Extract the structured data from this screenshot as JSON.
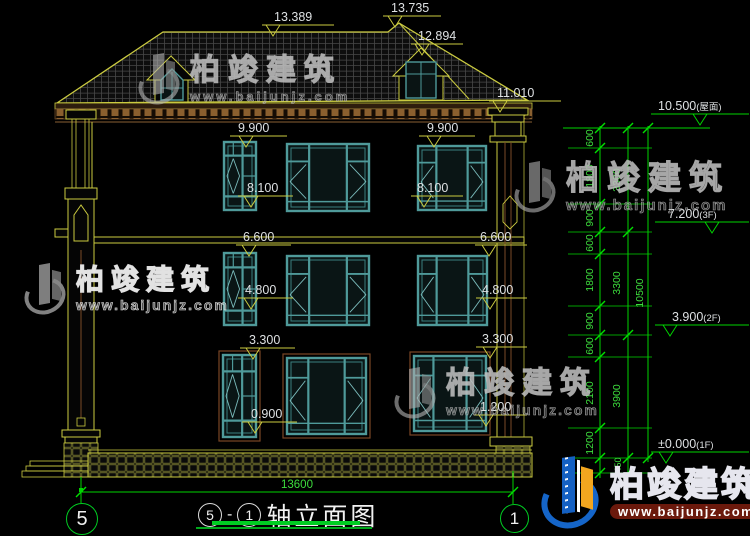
{
  "drawing": {
    "title": {
      "axis_start": "5",
      "dash": "-",
      "axis_end": "1",
      "name": "轴立面图"
    },
    "axis_bubbles": {
      "left": "5",
      "right": "1"
    },
    "bottom_dim": "13600"
  },
  "brand": {
    "name": "柏竣建筑",
    "url": "www.baijunjz.com"
  },
  "colors": {
    "line_yellow": "#cbcb40",
    "line_green": "#00d400",
    "green_text": "#3ddd3d",
    "window_teal": "#4f9a9a",
    "window_highlight": "#7bbcbc",
    "text_white": "#dde0e2",
    "brown": "#7a4a28",
    "brand_blue": "#1565c8",
    "brand_orange": "#f2a61f"
  },
  "geometry": {
    "markers": [
      {
        "t": "13.389",
        "x1": 262,
        "x2": 334,
        "y": 25,
        "tx": 273,
        "lx": 274,
        "ly": 21
      },
      {
        "t": "13.735",
        "x1": 383,
        "x2": 441,
        "y": 16,
        "tx": 395,
        "lx": 391,
        "ly": 12
      },
      {
        "t": "12.894",
        "x1": 411,
        "x2": 463,
        "y": 44,
        "tx": 422,
        "lx": 418,
        "ly": 40
      },
      {
        "t": "11.010",
        "x1": 489,
        "x2": 561,
        "y": 101,
        "tx": 500,
        "lx": 497,
        "ly": 97
      },
      {
        "t": "9.900",
        "x1": 230,
        "x2": 287,
        "y": 136,
        "tx": 246,
        "lx": 238,
        "ly": 132
      },
      {
        "t": "9.900",
        "x1": 419,
        "x2": 475,
        "y": 136,
        "tx": 434,
        "lx": 427,
        "ly": 132
      },
      {
        "t": "8.100",
        "x1": 238,
        "x2": 293,
        "y": 196,
        "tx": 251,
        "lx": 247,
        "ly": 192
      },
      {
        "t": "8.100",
        "x1": 411,
        "x2": 463,
        "y": 196,
        "tx": 424,
        "lx": 417,
        "ly": 192
      },
      {
        "t": "6.600",
        "x1": 236,
        "x2": 291,
        "y": 245,
        "tx": 249,
        "lx": 243,
        "ly": 241
      },
      {
        "t": "6.600",
        "x1": 475,
        "x2": 527,
        "y": 245,
        "tx": 489,
        "lx": 480,
        "ly": 241
      },
      {
        "t": "4.800",
        "x1": 238,
        "x2": 293,
        "y": 298,
        "tx": 251,
        "lx": 245,
        "ly": 294
      },
      {
        "t": "4.800",
        "x1": 476,
        "x2": 527,
        "y": 298,
        "tx": 490,
        "lx": 482,
        "ly": 294
      },
      {
        "t": "3.300",
        "x1": 240,
        "x2": 295,
        "y": 348,
        "tx": 253,
        "lx": 249,
        "ly": 344
      },
      {
        "t": "3.300",
        "x1": 476,
        "x2": 527,
        "y": 347,
        "tx": 490,
        "lx": 482,
        "ly": 343
      },
      {
        "t": "0.900",
        "x1": 242,
        "x2": 297,
        "y": 422,
        "tx": 255,
        "lx": 251,
        "ly": 418
      },
      {
        "t": "1.200",
        "x1": 474,
        "x2": 527,
        "y": 415,
        "tx": 486,
        "lx": 480,
        "ly": 411
      }
    ],
    "levels": [
      {
        "v": "10.500",
        "f": "(屋面)",
        "y": 114,
        "x1": 651,
        "x2": 749,
        "tx": 700,
        "lx": 658,
        "ly": 110
      },
      {
        "v": "7.200",
        "f": "(3F)",
        "y": 222,
        "x1": 655,
        "x2": 749,
        "tx": 712,
        "lx": 668,
        "ly": 218
      },
      {
        "v": "3.900",
        "f": "(2F)",
        "y": 325,
        "x1": 655,
        "x2": 749,
        "tx": 670,
        "lx": 672,
        "ly": 321
      },
      {
        "v": "±0.000",
        "f": "(1F)",
        "y": 452,
        "x1": 651,
        "x2": 749,
        "tx": 666,
        "lx": 658,
        "ly": 448
      }
    ],
    "chain": {
      "verticals": [
        [
          600,
          126,
          478
        ],
        [
          628,
          126,
          478
        ],
        [
          648,
          126,
          462
        ]
      ],
      "inner_ticks": [
        128,
        148,
        204,
        232,
        254,
        306,
        335,
        357,
        428,
        458,
        473
      ],
      "mid_ticks": [
        128,
        232,
        335,
        458,
        473
      ],
      "outer_ticks": [
        128,
        458
      ],
      "labels": [
        {
          "t": "600",
          "x": 593,
          "y": 138
        },
        {
          "t": "1800",
          "x": 593,
          "y": 176
        },
        {
          "t": "900",
          "x": 593,
          "y": 218
        },
        {
          "t": "600",
          "x": 593,
          "y": 243
        },
        {
          "t": "1800",
          "x": 593,
          "y": 280
        },
        {
          "t": "900",
          "x": 593,
          "y": 321
        },
        {
          "t": "600",
          "x": 593,
          "y": 346
        },
        {
          "t": "2100",
          "x": 593,
          "y": 393
        },
        {
          "t": "1200",
          "x": 593,
          "y": 443
        },
        {
          "t": "450",
          "x": 621,
          "y": 465,
          "s": 9
        },
        {
          "t": "3300",
          "x": 620,
          "y": 180
        },
        {
          "t": "3300",
          "x": 620,
          "y": 283
        },
        {
          "t": "3900",
          "x": 620,
          "y": 396
        },
        {
          "t": "10500",
          "x": 643,
          "y": 293
        }
      ]
    },
    "bottom": {
      "lineY": 492,
      "x1": 81,
      "x2": 513,
      "tx": 297,
      "ty": 488
    },
    "windows": [
      {
        "x": 224,
        "y": 142,
        "w": 32,
        "h": 68,
        "k": "n"
      },
      {
        "x": 287,
        "y": 144,
        "w": 82,
        "h": 67,
        "k": "w"
      },
      {
        "x": 418,
        "y": 146,
        "w": 68,
        "h": 64,
        "k": "w"
      },
      {
        "x": 224,
        "y": 253,
        "w": 32,
        "h": 72,
        "k": "n"
      },
      {
        "x": 287,
        "y": 256,
        "w": 82,
        "h": 69,
        "k": "w"
      },
      {
        "x": 418,
        "y": 256,
        "w": 69,
        "h": 69,
        "k": "w"
      },
      {
        "x": 223,
        "y": 355,
        "w": 33,
        "h": 82,
        "k": "n",
        "f": 1
      },
      {
        "x": 287,
        "y": 358,
        "w": 79,
        "h": 76,
        "k": "w",
        "f": 1
      },
      {
        "x": 414,
        "y": 356,
        "w": 72,
        "h": 75,
        "k": "w",
        "f": 1
      }
    ]
  }
}
